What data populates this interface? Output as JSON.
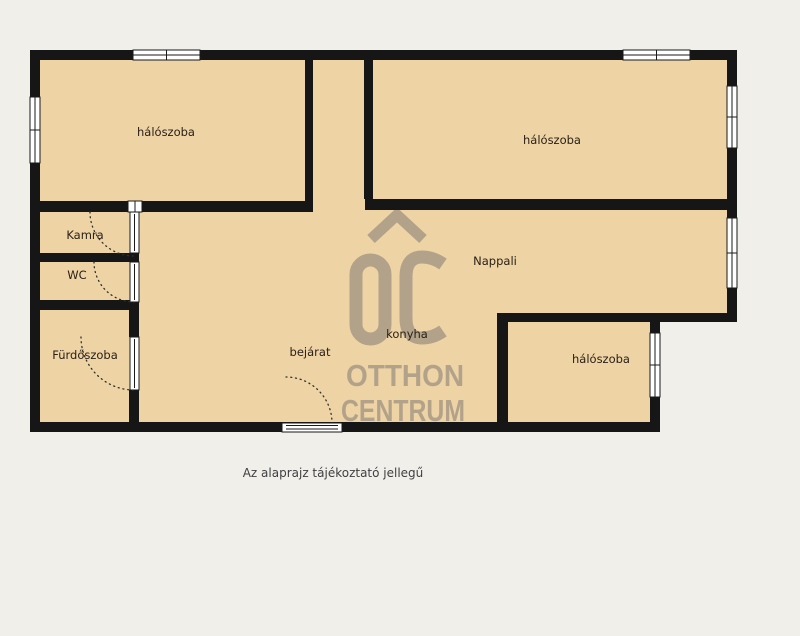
{
  "colors": {
    "background": "#f1efea",
    "room_fill": "#eed3a5",
    "wall": "#161616",
    "watermark": "#b2a28a",
    "label_text": "#2a2118",
    "caption_text": "#3f3f41"
  },
  "labels": {
    "bedroom_top_left": "hálószoba",
    "bedroom_top_right": "hálószoba",
    "bedroom_bottom_right": "hálószoba",
    "pantry": "Kamra",
    "wc": "WC",
    "bathroom": "Fürdőszoba",
    "living_room": "Nappali",
    "kitchen": "konyha",
    "entrance": "bejárat"
  },
  "watermark": {
    "logo_text": "ŐC",
    "line1": "OTTHON",
    "line2": "CENTRUM"
  },
  "caption": "Az alaprajz tájékoztató jellegű"
}
